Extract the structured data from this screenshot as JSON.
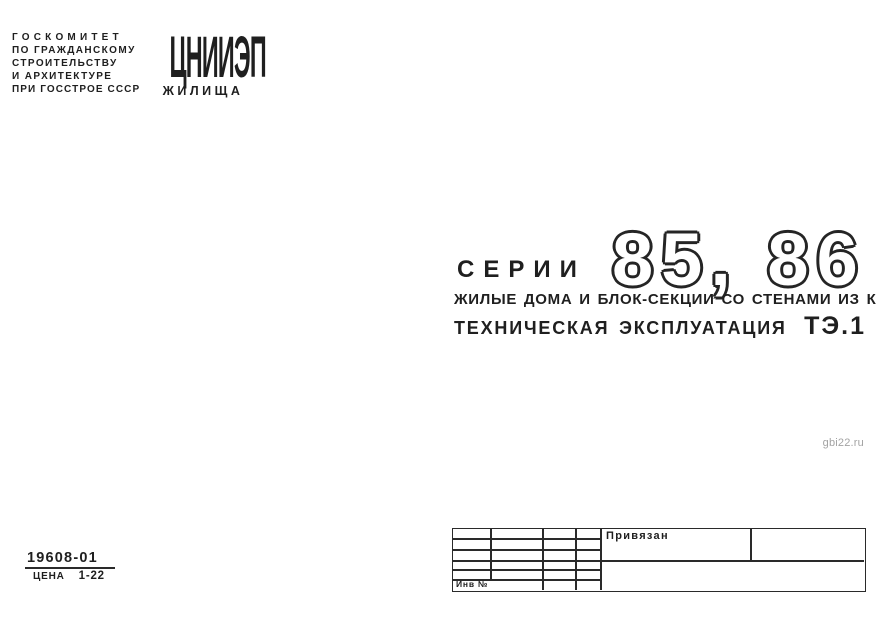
{
  "colors": {
    "ink": "#1f1f1f",
    "paper": "#ffffff",
    "watermark_gray": "#a3a3a3"
  },
  "publisher": {
    "lines": [
      "ГОСКОМИТЕТ",
      "ПО ГРАЖДАНСКОМУ",
      "СТРОИТЕЛЬСТВУ",
      "И АРХИТЕКТУРЕ",
      "ПРИ ГОССТРОЕ СССР"
    ]
  },
  "logo": {
    "top": "ЦНИИЭП",
    "bottom": "ЖИЛИЩА"
  },
  "title": {
    "series_label": "СЕРИИ",
    "series_numbers": "85, 86",
    "subtitle": "ЖИЛЫЕ ДОМА И БЛОК-СЕКЦИИ СО СТЕНАМИ ИЗ КИРПИЧА",
    "doc_type": "ТЕХНИЧЕСКАЯ ЭКСПЛУАТАЦИЯ",
    "doc_code": "ТЭ.1"
  },
  "watermark": "gbi22.ru",
  "footer": {
    "code": "19608-01",
    "price_label": "ЦЕНА",
    "price_value": "1-22"
  },
  "stamp": {
    "attached_label": "Привязан",
    "inventory_label": "Инв №"
  }
}
